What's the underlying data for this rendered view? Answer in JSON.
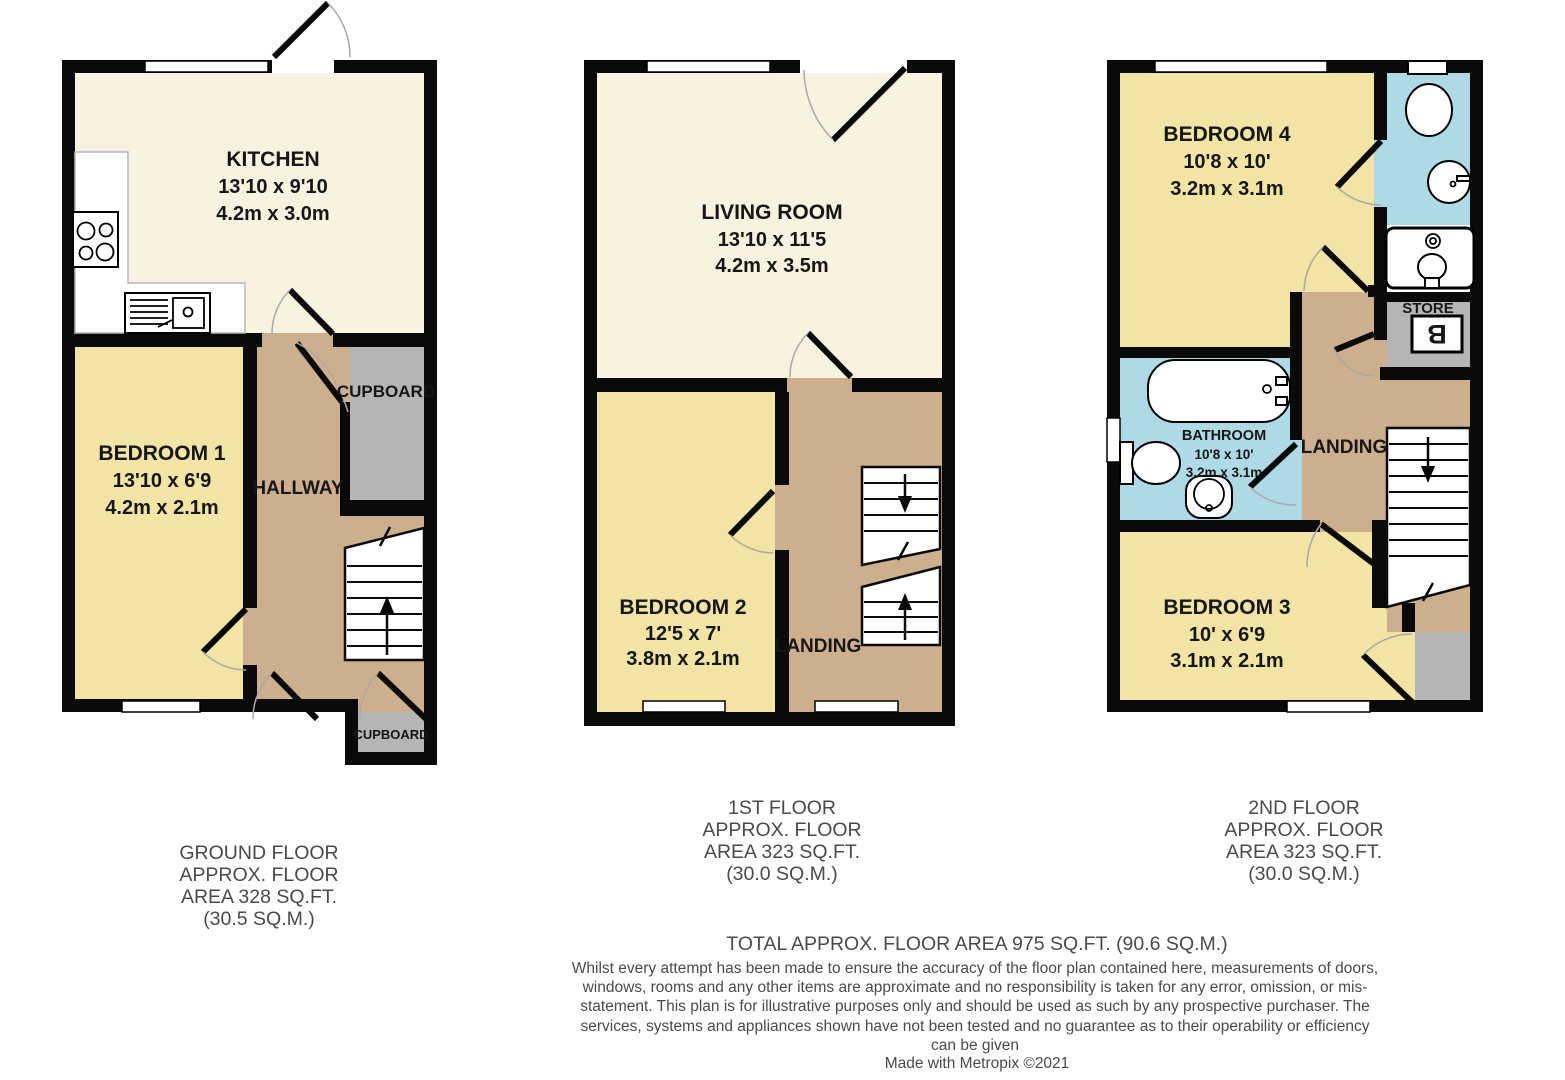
{
  "palette": {
    "wall": "#0A0A0A",
    "room_cream": "#FAF2E0",
    "room_yellow": "#F1E4A4",
    "hall_tan": "#CDAF8D",
    "cupboard_gray": "#B5B5B5",
    "bath_blue": "#AEDAE6",
    "label_text": "#161616",
    "caption_text": "#4A4A4A"
  },
  "rooms": {
    "kitchen": {
      "name": "KITCHEN",
      "imperial": "13'10 x 9'10",
      "metric": "4.2m x 3.0m"
    },
    "bedroom1": {
      "name": "BEDROOM 1",
      "imperial": "13'10 x 6'9",
      "metric": "4.2m x 2.1m"
    },
    "hallway": {
      "name": "HALLWAY"
    },
    "cupboard_hall": {
      "name": "CUPBOARD"
    },
    "cupboard_entry": {
      "name": "CUPBOARD"
    },
    "living_room": {
      "name": "LIVING ROOM",
      "imperial": "13'10 x 11'5",
      "metric": "4.2m x 3.5m"
    },
    "bedroom2": {
      "name": "BEDROOM 2",
      "imperial": "12'5 x 7'",
      "metric": "3.8m x 2.1m"
    },
    "landing1": {
      "name": "LANDING"
    },
    "bedroom4": {
      "name": "BEDROOM 4",
      "imperial": "10'8 x 10'",
      "metric": "3.2m x 3.1m"
    },
    "bathroom": {
      "name": "BATHROOM",
      "imperial": "10'8 x 10'",
      "metric": "3.2m x 3.1m"
    },
    "landing2": {
      "name": "LANDING"
    },
    "store": {
      "name": "STORE"
    },
    "boiler": {
      "symbol": "B"
    },
    "bedroom3": {
      "name": "BEDROOM 3",
      "imperial": "10' x 6'9",
      "metric": "3.1m x 2.1m"
    }
  },
  "floors": [
    {
      "caption": "GROUND FLOOR\nAPPROX. FLOOR\nAREA 328 SQ.FT.\n(30.5 SQ.M.)"
    },
    {
      "caption": "1ST FLOOR\nAPPROX. FLOOR\nAREA 323 SQ.FT.\n(30.0 SQ.M.)"
    },
    {
      "caption": "2ND FLOOR\nAPPROX. FLOOR\nAREA 323 SQ.FT.\n(30.0 SQ.M.)"
    }
  ],
  "footer": {
    "total": "TOTAL APPROX. FLOOR AREA 975 SQ.FT. (90.6 SQ.M.)",
    "disclaimer": "Whilst every attempt has been made to ensure the accuracy of the floor plan contained here, measurements of doors, windows, rooms and any other items are approximate and no responsibility is taken for any error, omission, or mis-statement. This plan is for illustrative purposes only and should be used as such by any prospective purchaser. The services, systems and appliances shown have not been tested and no guarantee as to their operability or efficiency can be given",
    "credit": "Made with Metropix ©2021"
  }
}
